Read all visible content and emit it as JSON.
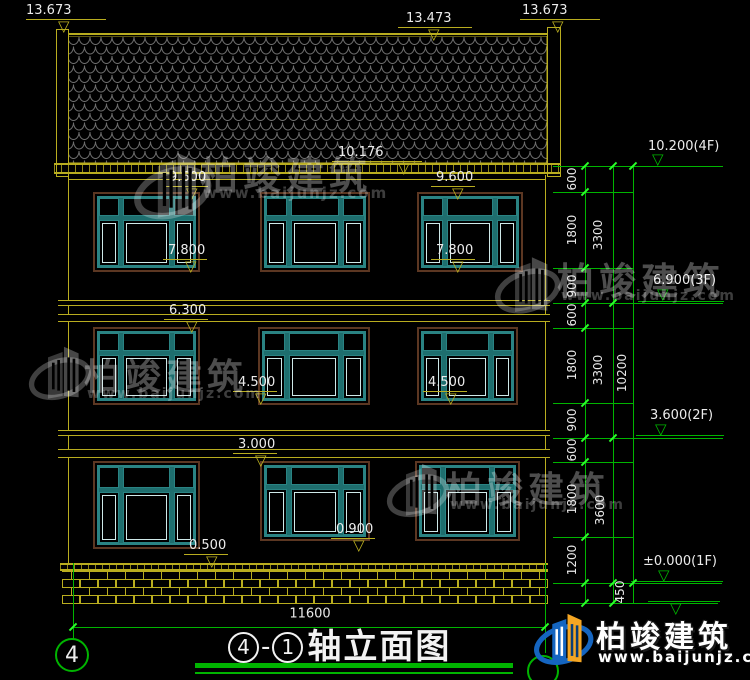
{
  "title_block": {
    "circle_left": "4",
    "dash": "-",
    "circle_right": "1",
    "title_text": "轴立面图"
  },
  "brand": {
    "name": "柏竣建筑",
    "url": "www.baijunjz.com"
  },
  "colors": {
    "cad_yellow": "#b9ad1f",
    "cad_green": "#00b400",
    "tick_green": "#2aff2a",
    "window_teal": "#1e6e6e",
    "window_brown": "#5c3722",
    "tile_gray": "#6e6e6e",
    "logo_blue": "#1565c0",
    "logo_orange": "#f5a623"
  },
  "axis_markers": [
    {
      "label": "4",
      "cx": 72,
      "cy": 655,
      "r": 17
    },
    {
      "label": "",
      "cx": 543,
      "cy": 671,
      "r": 16
    }
  ],
  "elevation_markers": [
    {
      "label": "13.673",
      "color": "#b9ad1f",
      "style": "A",
      "tx": 26,
      "ty": 4,
      "lx": 26,
      "ly": 19,
      "lw": 80,
      "trix": 58,
      "triy": 20
    },
    {
      "label": "13.473",
      "color": "#b9ad1f",
      "style": "A",
      "tx": 406,
      "ty": 12,
      "lx": 398,
      "ly": 27,
      "lw": 74,
      "trix": 428,
      "triy": 28
    },
    {
      "label": "13.673",
      "color": "#b9ad1f",
      "style": "A",
      "tx": 522,
      "ty": 4,
      "lx": 520,
      "ly": 19,
      "lw": 80,
      "trix": 552,
      "triy": 20
    },
    {
      "label": "10.176",
      "color": "#b9ad1f",
      "style": "A",
      "tx": 338,
      "ty": 146,
      "lx": 332,
      "ly": 161,
      "lw": 90,
      "trix": 398,
      "triy": 162
    },
    {
      "label": "9.600",
      "color": "#b9ad1f",
      "style": "A",
      "tx": 169,
      "ty": 171,
      "lx": 164,
      "ly": 186,
      "lw": 44,
      "trix": 186,
      "triy": 187
    },
    {
      "label": "9.600",
      "color": "#b9ad1f",
      "style": "A",
      "tx": 436,
      "ty": 171,
      "lx": 431,
      "ly": 186,
      "lw": 44,
      "trix": 452,
      "triy": 187
    },
    {
      "label": "7.800",
      "color": "#b9ad1f",
      "style": "A",
      "tx": 168,
      "ty": 244,
      "lx": 163,
      "ly": 259,
      "lw": 44,
      "trix": 185,
      "triy": 260
    },
    {
      "label": "7.800",
      "color": "#b9ad1f",
      "style": "A",
      "tx": 436,
      "ty": 244,
      "lx": 431,
      "ly": 259,
      "lw": 44,
      "trix": 452,
      "triy": 260
    },
    {
      "label": "6.300",
      "color": "#b9ad1f",
      "style": "A",
      "tx": 169,
      "ty": 304,
      "lx": 164,
      "ly": 319,
      "lw": 44,
      "trix": 186,
      "triy": 320
    },
    {
      "label": "4.500",
      "color": "#b9ad1f",
      "style": "A",
      "tx": 238,
      "ty": 376,
      "lx": 233,
      "ly": 391,
      "lw": 44,
      "trix": 255,
      "triy": 392
    },
    {
      "label": "4.500",
      "color": "#b9ad1f",
      "style": "A",
      "tx": 428,
      "ty": 376,
      "lx": 423,
      "ly": 391,
      "lw": 44,
      "trix": 445,
      "triy": 392
    },
    {
      "label": "3.000",
      "color": "#b9ad1f",
      "style": "A",
      "tx": 238,
      "ty": 438,
      "lx": 233,
      "ly": 453,
      "lw": 44,
      "trix": 255,
      "triy": 454
    },
    {
      "label": "0.500",
      "color": "#b9ad1f",
      "style": "A",
      "tx": 189,
      "ty": 539,
      "lx": 184,
      "ly": 554,
      "lw": 44,
      "trix": 206,
      "triy": 555
    },
    {
      "label": "0.900",
      "color": "#b9ad1f",
      "style": "A",
      "tx": 336,
      "ty": 523,
      "lx": 331,
      "ly": 538,
      "lw": 44,
      "trix": 353,
      "triy": 539
    },
    {
      "label": "10.200(4F)",
      "color": "#00b400",
      "style": "B",
      "tx": 648,
      "ty": 140,
      "lx": 633,
      "ly": 166,
      "lw": 90,
      "trix": 652,
      "triy": 153
    },
    {
      "label": "6.900(3F)",
      "color": "#00b400",
      "style": "B",
      "tx": 653,
      "ty": 274,
      "lx": 638,
      "ly": 301,
      "lw": 86,
      "trix": 657,
      "triy": 288
    },
    {
      "label": "3.600(2F)",
      "color": "#00b400",
      "style": "B",
      "tx": 650,
      "ty": 409,
      "lx": 636,
      "ly": 435,
      "lw": 88,
      "trix": 655,
      "triy": 423
    },
    {
      "label": "±0.000(1F)",
      "color": "#00b400",
      "style": "B",
      "tx": 643,
      "ty": 555,
      "lx": 631,
      "ly": 581,
      "lw": 92,
      "trix": 658,
      "triy": 569
    },
    {
      "label": "",
      "color": "#00b400",
      "style": "A",
      "tx": 0,
      "ty": 0,
      "lx": 648,
      "ly": 601,
      "lw": 72,
      "trix": 670,
      "triy": 602
    }
  ],
  "dim_chain": {
    "vlines": [
      {
        "x": 585,
        "y1": 166,
        "y2": 603
      },
      {
        "x": 613,
        "y1": 166,
        "y2": 603
      },
      {
        "x": 633,
        "y1": 166,
        "y2": 603
      }
    ],
    "hlines": [
      {
        "y": 166,
        "x1": 553,
        "x2": 722
      },
      {
        "y": 192,
        "x1": 553,
        "x2": 634
      },
      {
        "y": 268,
        "x1": 553,
        "x2": 634
      },
      {
        "y": 303,
        "x1": 553,
        "x2": 723
      },
      {
        "y": 328,
        "x1": 553,
        "x2": 634
      },
      {
        "y": 403,
        "x1": 553,
        "x2": 634
      },
      {
        "y": 438,
        "x1": 553,
        "x2": 723
      },
      {
        "y": 462,
        "x1": 553,
        "x2": 634
      },
      {
        "y": 537,
        "x1": 553,
        "x2": 634
      },
      {
        "y": 583,
        "x1": 553,
        "x2": 722
      },
      {
        "y": 603,
        "x1": 560,
        "x2": 718
      }
    ],
    "ticks": [
      {
        "x": 585,
        "y": 166
      },
      {
        "x": 585,
        "y": 192
      },
      {
        "x": 585,
        "y": 268
      },
      {
        "x": 585,
        "y": 303
      },
      {
        "x": 585,
        "y": 328
      },
      {
        "x": 585,
        "y": 403
      },
      {
        "x": 585,
        "y": 438
      },
      {
        "x": 585,
        "y": 462
      },
      {
        "x": 585,
        "y": 537
      },
      {
        "x": 585,
        "y": 583
      },
      {
        "x": 585,
        "y": 603
      },
      {
        "x": 613,
        "y": 166
      },
      {
        "x": 613,
        "y": 303
      },
      {
        "x": 613,
        "y": 438
      },
      {
        "x": 613,
        "y": 583
      },
      {
        "x": 613,
        "y": 603
      },
      {
        "x": 633,
        "y": 166
      },
      {
        "x": 633,
        "y": 583
      }
    ],
    "labels": [
      {
        "t": "600",
        "x": 572,
        "y": 179
      },
      {
        "t": "1800",
        "x": 572,
        "y": 230
      },
      {
        "t": "900",
        "x": 572,
        "y": 286
      },
      {
        "t": "600",
        "x": 572,
        "y": 315
      },
      {
        "t": "1800",
        "x": 572,
        "y": 365
      },
      {
        "t": "900",
        "x": 572,
        "y": 420
      },
      {
        "t": "600",
        "x": 572,
        "y": 450
      },
      {
        "t": "1800",
        "x": 572,
        "y": 499
      },
      {
        "t": "1200",
        "x": 572,
        "y": 560
      },
      {
        "t": "3300",
        "x": 598,
        "y": 235
      },
      {
        "t": "3300",
        "x": 598,
        "y": 370
      },
      {
        "t": "3600",
        "x": 600,
        "y": 510
      },
      {
        "t": "10200",
        "x": 622,
        "y": 373
      },
      {
        "t": "450",
        "x": 620,
        "y": 592
      }
    ]
  },
  "bottom_dim": {
    "label": "11600",
    "label_x": 310,
    "label_y": 614,
    "line": {
      "y": 627,
      "x1": 73,
      "x2": 545
    },
    "ext": [
      {
        "x": 73,
        "y1": 563,
        "y2": 640
      },
      {
        "x": 545,
        "y1": 563,
        "y2": 653
      }
    ],
    "ticks": [
      {
        "x": 73,
        "y": 627
      },
      {
        "x": 545,
        "y": 627
      }
    ]
  },
  "windows": [
    {
      "x": 93,
      "y": 192,
      "w": 107,
      "h": 80
    },
    {
      "x": 260,
      "y": 192,
      "w": 110,
      "h": 80
    },
    {
      "x": 417,
      "y": 192,
      "w": 106,
      "h": 80
    },
    {
      "x": 93,
      "y": 327,
      "w": 107,
      "h": 78
    },
    {
      "x": 258,
      "y": 327,
      "w": 112,
      "h": 78
    },
    {
      "x": 417,
      "y": 327,
      "w": 101,
      "h": 78
    },
    {
      "x": 93,
      "y": 461,
      "w": 107,
      "h": 88
    },
    {
      "x": 260,
      "y": 461,
      "w": 110,
      "h": 80
    },
    {
      "x": 415,
      "y": 461,
      "w": 105,
      "h": 80
    }
  ],
  "watermarks": [
    {
      "ix": 133,
      "iy": 141,
      "is": 92,
      "tx": 200,
      "ty": 145,
      "tfs": 38,
      "ux": 203,
      "uy": 184,
      "ufs": 15
    },
    {
      "ix": 28,
      "iy": 337,
      "is": 74,
      "tx": 84,
      "ty": 348,
      "tfs": 36,
      "ux": 87,
      "uy": 386,
      "ufs": 14
    },
    {
      "ix": 494,
      "iy": 247,
      "is": 78,
      "tx": 557,
      "ty": 251,
      "tfs": 37,
      "ux": 561,
      "uy": 288,
      "ufs": 14
    },
    {
      "ix": 386,
      "iy": 454,
      "is": 74,
      "tx": 446,
      "ty": 461,
      "tfs": 36,
      "ux": 450,
      "uy": 497,
      "ufs": 14
    }
  ]
}
